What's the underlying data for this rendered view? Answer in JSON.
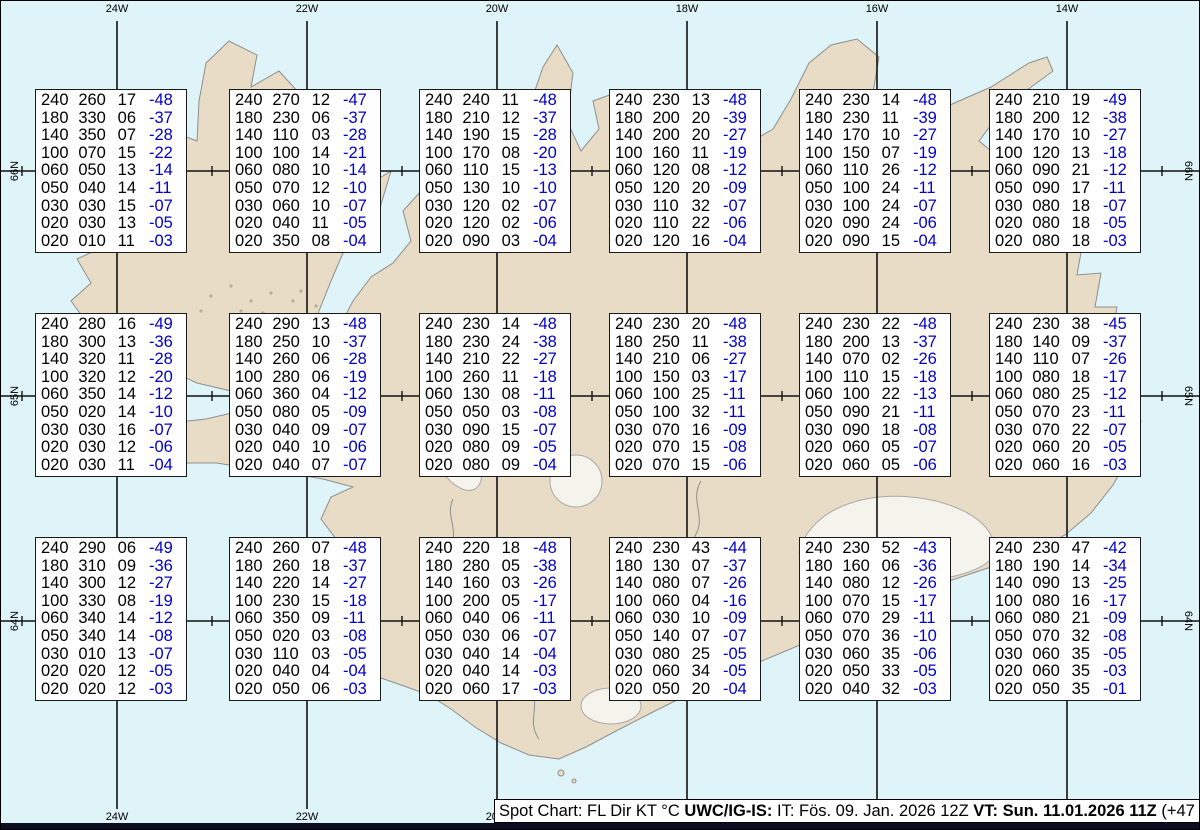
{
  "colors": {
    "water": "#dff4f8",
    "land": "#e8dcc6",
    "coast": "#8f8f8f",
    "grid": "#111111",
    "temp_blue": "#0000cc",
    "glacier": "#f5f4ec",
    "footer_bar": "#0d0d20"
  },
  "map": {
    "lon_labels": [
      "24W",
      "22W",
      "20W",
      "18W",
      "16W",
      "14W"
    ],
    "lat_labels": [
      "66N",
      "65N",
      "64N"
    ]
  },
  "footer": {
    "prefix": "Spot Chart: FL Dir KT °C ",
    "org": "UWC/IG-IS:",
    "mid": " IT: Fös. 09. Jan. 2026 12Z ",
    "valid": "VT: Sun. 11.01.2026 11Z",
    "suffix": " (+47 h)"
  },
  "spots": [
    {
      "rows": [
        [
          "240",
          "260",
          "17",
          "-48"
        ],
        [
          "180",
          "330",
          "06",
          "-37"
        ],
        [
          "140",
          "350",
          "07",
          "-28"
        ],
        [
          "100",
          "070",
          "15",
          "-22"
        ],
        [
          "060",
          "050",
          "13",
          "-14"
        ],
        [
          "050",
          "040",
          "14",
          "-11"
        ],
        [
          "030",
          "030",
          "15",
          "-07"
        ],
        [
          "020",
          "030",
          "13",
          "-05"
        ],
        [
          "020",
          "010",
          "11",
          "-03"
        ]
      ]
    },
    {
      "rows": [
        [
          "240",
          "270",
          "12",
          "-47"
        ],
        [
          "180",
          "230",
          "06",
          "-37"
        ],
        [
          "140",
          "110",
          "03",
          "-28"
        ],
        [
          "100",
          "100",
          "14",
          "-21"
        ],
        [
          "060",
          "080",
          "10",
          "-14"
        ],
        [
          "050",
          "070",
          "12",
          "-10"
        ],
        [
          "030",
          "060",
          "10",
          "-07"
        ],
        [
          "020",
          "040",
          "11",
          "-05"
        ],
        [
          "020",
          "350",
          "08",
          "-04"
        ]
      ]
    },
    {
      "rows": [
        [
          "240",
          "240",
          "11",
          "-48"
        ],
        [
          "180",
          "210",
          "12",
          "-37"
        ],
        [
          "140",
          "190",
          "15",
          "-28"
        ],
        [
          "100",
          "170",
          "08",
          "-20"
        ],
        [
          "060",
          "110",
          "15",
          "-13"
        ],
        [
          "050",
          "130",
          "10",
          "-10"
        ],
        [
          "030",
          "120",
          "02",
          "-07"
        ],
        [
          "020",
          "120",
          "02",
          "-06"
        ],
        [
          "020",
          "090",
          "03",
          "-04"
        ]
      ]
    },
    {
      "rows": [
        [
          "240",
          "230",
          "13",
          "-48"
        ],
        [
          "180",
          "200",
          "20",
          "-39"
        ],
        [
          "140",
          "200",
          "20",
          "-27"
        ],
        [
          "100",
          "160",
          "11",
          "-19"
        ],
        [
          "060",
          "120",
          "08",
          "-12"
        ],
        [
          "050",
          "120",
          "20",
          "-09"
        ],
        [
          "030",
          "110",
          "32",
          "-07"
        ],
        [
          "020",
          "110",
          "22",
          "-06"
        ],
        [
          "020",
          "120",
          "16",
          "-04"
        ]
      ]
    },
    {
      "rows": [
        [
          "240",
          "230",
          "14",
          "-48"
        ],
        [
          "180",
          "230",
          "11",
          "-39"
        ],
        [
          "140",
          "170",
          "10",
          "-27"
        ],
        [
          "100",
          "150",
          "07",
          "-19"
        ],
        [
          "060",
          "110",
          "26",
          "-12"
        ],
        [
          "050",
          "100",
          "24",
          "-11"
        ],
        [
          "030",
          "100",
          "24",
          "-07"
        ],
        [
          "020",
          "090",
          "24",
          "-06"
        ],
        [
          "020",
          "090",
          "15",
          "-04"
        ]
      ]
    },
    {
      "rows": [
        [
          "240",
          "210",
          "19",
          "-49"
        ],
        [
          "180",
          "200",
          "12",
          "-38"
        ],
        [
          "140",
          "170",
          "10",
          "-27"
        ],
        [
          "100",
          "120",
          "13",
          "-18"
        ],
        [
          "060",
          "090",
          "21",
          "-12"
        ],
        [
          "050",
          "090",
          "17",
          "-11"
        ],
        [
          "030",
          "080",
          "18",
          "-07"
        ],
        [
          "020",
          "080",
          "18",
          "-05"
        ],
        [
          "020",
          "080",
          "18",
          "-03"
        ]
      ]
    },
    {
      "rows": [
        [
          "240",
          "280",
          "16",
          "-49"
        ],
        [
          "180",
          "300",
          "13",
          "-36"
        ],
        [
          "140",
          "320",
          "11",
          "-28"
        ],
        [
          "100",
          "320",
          "12",
          "-20"
        ],
        [
          "060",
          "350",
          "14",
          "-12"
        ],
        [
          "050",
          "020",
          "14",
          "-10"
        ],
        [
          "030",
          "030",
          "16",
          "-07"
        ],
        [
          "020",
          "030",
          "12",
          "-06"
        ],
        [
          "020",
          "030",
          "11",
          "-04"
        ]
      ]
    },
    {
      "rows": [
        [
          "240",
          "290",
          "13",
          "-48"
        ],
        [
          "180",
          "250",
          "10",
          "-37"
        ],
        [
          "140",
          "260",
          "06",
          "-28"
        ],
        [
          "100",
          "280",
          "06",
          "-19"
        ],
        [
          "060",
          "360",
          "04",
          "-12"
        ],
        [
          "050",
          "080",
          "05",
          "-09"
        ],
        [
          "030",
          "040",
          "09",
          "-07"
        ],
        [
          "020",
          "040",
          "10",
          "-06"
        ],
        [
          "020",
          "040",
          "07",
          "-07"
        ]
      ]
    },
    {
      "rows": [
        [
          "240",
          "230",
          "14",
          "-48"
        ],
        [
          "180",
          "230",
          "24",
          "-38"
        ],
        [
          "140",
          "210",
          "22",
          "-27"
        ],
        [
          "100",
          "260",
          "11",
          "-18"
        ],
        [
          "060",
          "130",
          "08",
          "-11"
        ],
        [
          "050",
          "050",
          "03",
          "-08"
        ],
        [
          "030",
          "090",
          "15",
          "-07"
        ],
        [
          "020",
          "080",
          "09",
          "-05"
        ],
        [
          "020",
          "080",
          "09",
          "-04"
        ]
      ]
    },
    {
      "rows": [
        [
          "240",
          "230",
          "20",
          "-48"
        ],
        [
          "180",
          "250",
          "11",
          "-38"
        ],
        [
          "140",
          "210",
          "06",
          "-27"
        ],
        [
          "100",
          "150",
          "03",
          "-17"
        ],
        [
          "060",
          "100",
          "25",
          "-11"
        ],
        [
          "050",
          "100",
          "32",
          "-11"
        ],
        [
          "030",
          "070",
          "16",
          "-09"
        ],
        [
          "020",
          "070",
          "15",
          "-08"
        ],
        [
          "020",
          "070",
          "15",
          "-06"
        ]
      ]
    },
    {
      "rows": [
        [
          "240",
          "230",
          "22",
          "-48"
        ],
        [
          "180",
          "200",
          "13",
          "-37"
        ],
        [
          "140",
          "070",
          "02",
          "-26"
        ],
        [
          "100",
          "110",
          "15",
          "-18"
        ],
        [
          "060",
          "100",
          "22",
          "-13"
        ],
        [
          "050",
          "090",
          "21",
          "-11"
        ],
        [
          "030",
          "090",
          "18",
          "-08"
        ],
        [
          "020",
          "060",
          "05",
          "-07"
        ],
        [
          "020",
          "060",
          "05",
          "-06"
        ]
      ]
    },
    {
      "rows": [
        [
          "240",
          "230",
          "38",
          "-45"
        ],
        [
          "180",
          "140",
          "09",
          "-37"
        ],
        [
          "140",
          "110",
          "07",
          "-26"
        ],
        [
          "100",
          "080",
          "18",
          "-17"
        ],
        [
          "060",
          "080",
          "25",
          "-12"
        ],
        [
          "050",
          "070",
          "23",
          "-11"
        ],
        [
          "030",
          "070",
          "22",
          "-07"
        ],
        [
          "020",
          "060",
          "20",
          "-05"
        ],
        [
          "020",
          "060",
          "16",
          "-03"
        ]
      ]
    },
    {
      "rows": [
        [
          "240",
          "290",
          "06",
          "-49"
        ],
        [
          "180",
          "310",
          "09",
          "-36"
        ],
        [
          "140",
          "300",
          "12",
          "-27"
        ],
        [
          "100",
          "330",
          "08",
          "-19"
        ],
        [
          "060",
          "340",
          "14",
          "-12"
        ],
        [
          "050",
          "340",
          "14",
          "-08"
        ],
        [
          "030",
          "010",
          "13",
          "-07"
        ],
        [
          "020",
          "020",
          "12",
          "-05"
        ],
        [
          "020",
          "020",
          "12",
          "-03"
        ]
      ]
    },
    {
      "rows": [
        [
          "240",
          "260",
          "07",
          "-48"
        ],
        [
          "180",
          "260",
          "18",
          "-37"
        ],
        [
          "140",
          "220",
          "14",
          "-27"
        ],
        [
          "100",
          "230",
          "15",
          "-18"
        ],
        [
          "060",
          "350",
          "09",
          "-11"
        ],
        [
          "050",
          "020",
          "03",
          "-08"
        ],
        [
          "030",
          "110",
          "03",
          "-05"
        ],
        [
          "020",
          "040",
          "04",
          "-04"
        ],
        [
          "020",
          "050",
          "06",
          "-03"
        ]
      ]
    },
    {
      "rows": [
        [
          "240",
          "220",
          "18",
          "-48"
        ],
        [
          "180",
          "280",
          "05",
          "-38"
        ],
        [
          "140",
          "160",
          "03",
          "-26"
        ],
        [
          "100",
          "200",
          "05",
          "-17"
        ],
        [
          "060",
          "040",
          "06",
          "-11"
        ],
        [
          "050",
          "030",
          "06",
          "-07"
        ],
        [
          "030",
          "040",
          "14",
          "-04"
        ],
        [
          "020",
          "040",
          "14",
          "-03"
        ],
        [
          "020",
          "060",
          "17",
          "-03"
        ]
      ]
    },
    {
      "rows": [
        [
          "240",
          "230",
          "43",
          "-44"
        ],
        [
          "180",
          "130",
          "07",
          "-37"
        ],
        [
          "140",
          "080",
          "07",
          "-26"
        ],
        [
          "100",
          "060",
          "04",
          "-16"
        ],
        [
          "060",
          "030",
          "10",
          "-09"
        ],
        [
          "050",
          "140",
          "07",
          "-07"
        ],
        [
          "030",
          "080",
          "25",
          "-05"
        ],
        [
          "020",
          "060",
          "34",
          "-05"
        ],
        [
          "020",
          "050",
          "20",
          "-04"
        ]
      ]
    },
    {
      "rows": [
        [
          "240",
          "230",
          "52",
          "-43"
        ],
        [
          "180",
          "160",
          "06",
          "-36"
        ],
        [
          "140",
          "080",
          "12",
          "-26"
        ],
        [
          "100",
          "070",
          "15",
          "-17"
        ],
        [
          "060",
          "070",
          "29",
          "-11"
        ],
        [
          "050",
          "070",
          "36",
          "-10"
        ],
        [
          "030",
          "060",
          "35",
          "-06"
        ],
        [
          "020",
          "050",
          "33",
          "-05"
        ],
        [
          "020",
          "040",
          "32",
          "-03"
        ]
      ]
    },
    {
      "rows": [
        [
          "240",
          "230",
          "47",
          "-42"
        ],
        [
          "180",
          "190",
          "14",
          "-34"
        ],
        [
          "140",
          "090",
          "13",
          "-25"
        ],
        [
          "100",
          "080",
          "16",
          "-17"
        ],
        [
          "060",
          "080",
          "21",
          "-09"
        ],
        [
          "050",
          "070",
          "32",
          "-08"
        ],
        [
          "030",
          "060",
          "35",
          "-05"
        ],
        [
          "020",
          "060",
          "35",
          "-03"
        ],
        [
          "020",
          "050",
          "35",
          "-01"
        ]
      ]
    }
  ]
}
